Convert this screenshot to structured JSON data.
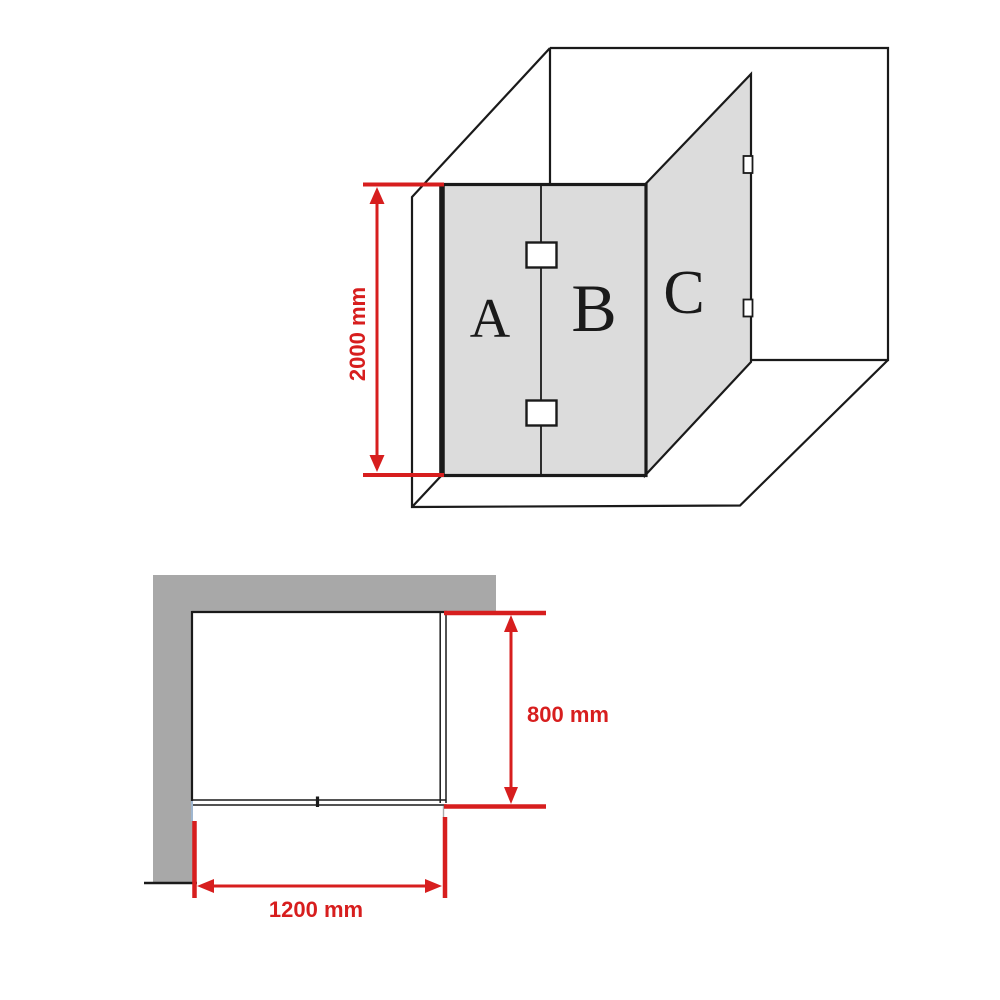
{
  "colors": {
    "dimension_red": "#d71e1e",
    "glass_gray": "#dcdcdc",
    "wall_gray": "#a8a8a8",
    "line_black": "#1a1a1a"
  },
  "perspective_view": {
    "panels": [
      {
        "label": "A"
      },
      {
        "label": "B"
      },
      {
        "label": "C"
      }
    ],
    "height_dimension": {
      "label": "2000 mm"
    }
  },
  "plan_view": {
    "depth_dimension": {
      "label": "800 mm"
    },
    "width_dimension": {
      "label": "1200 mm"
    }
  }
}
